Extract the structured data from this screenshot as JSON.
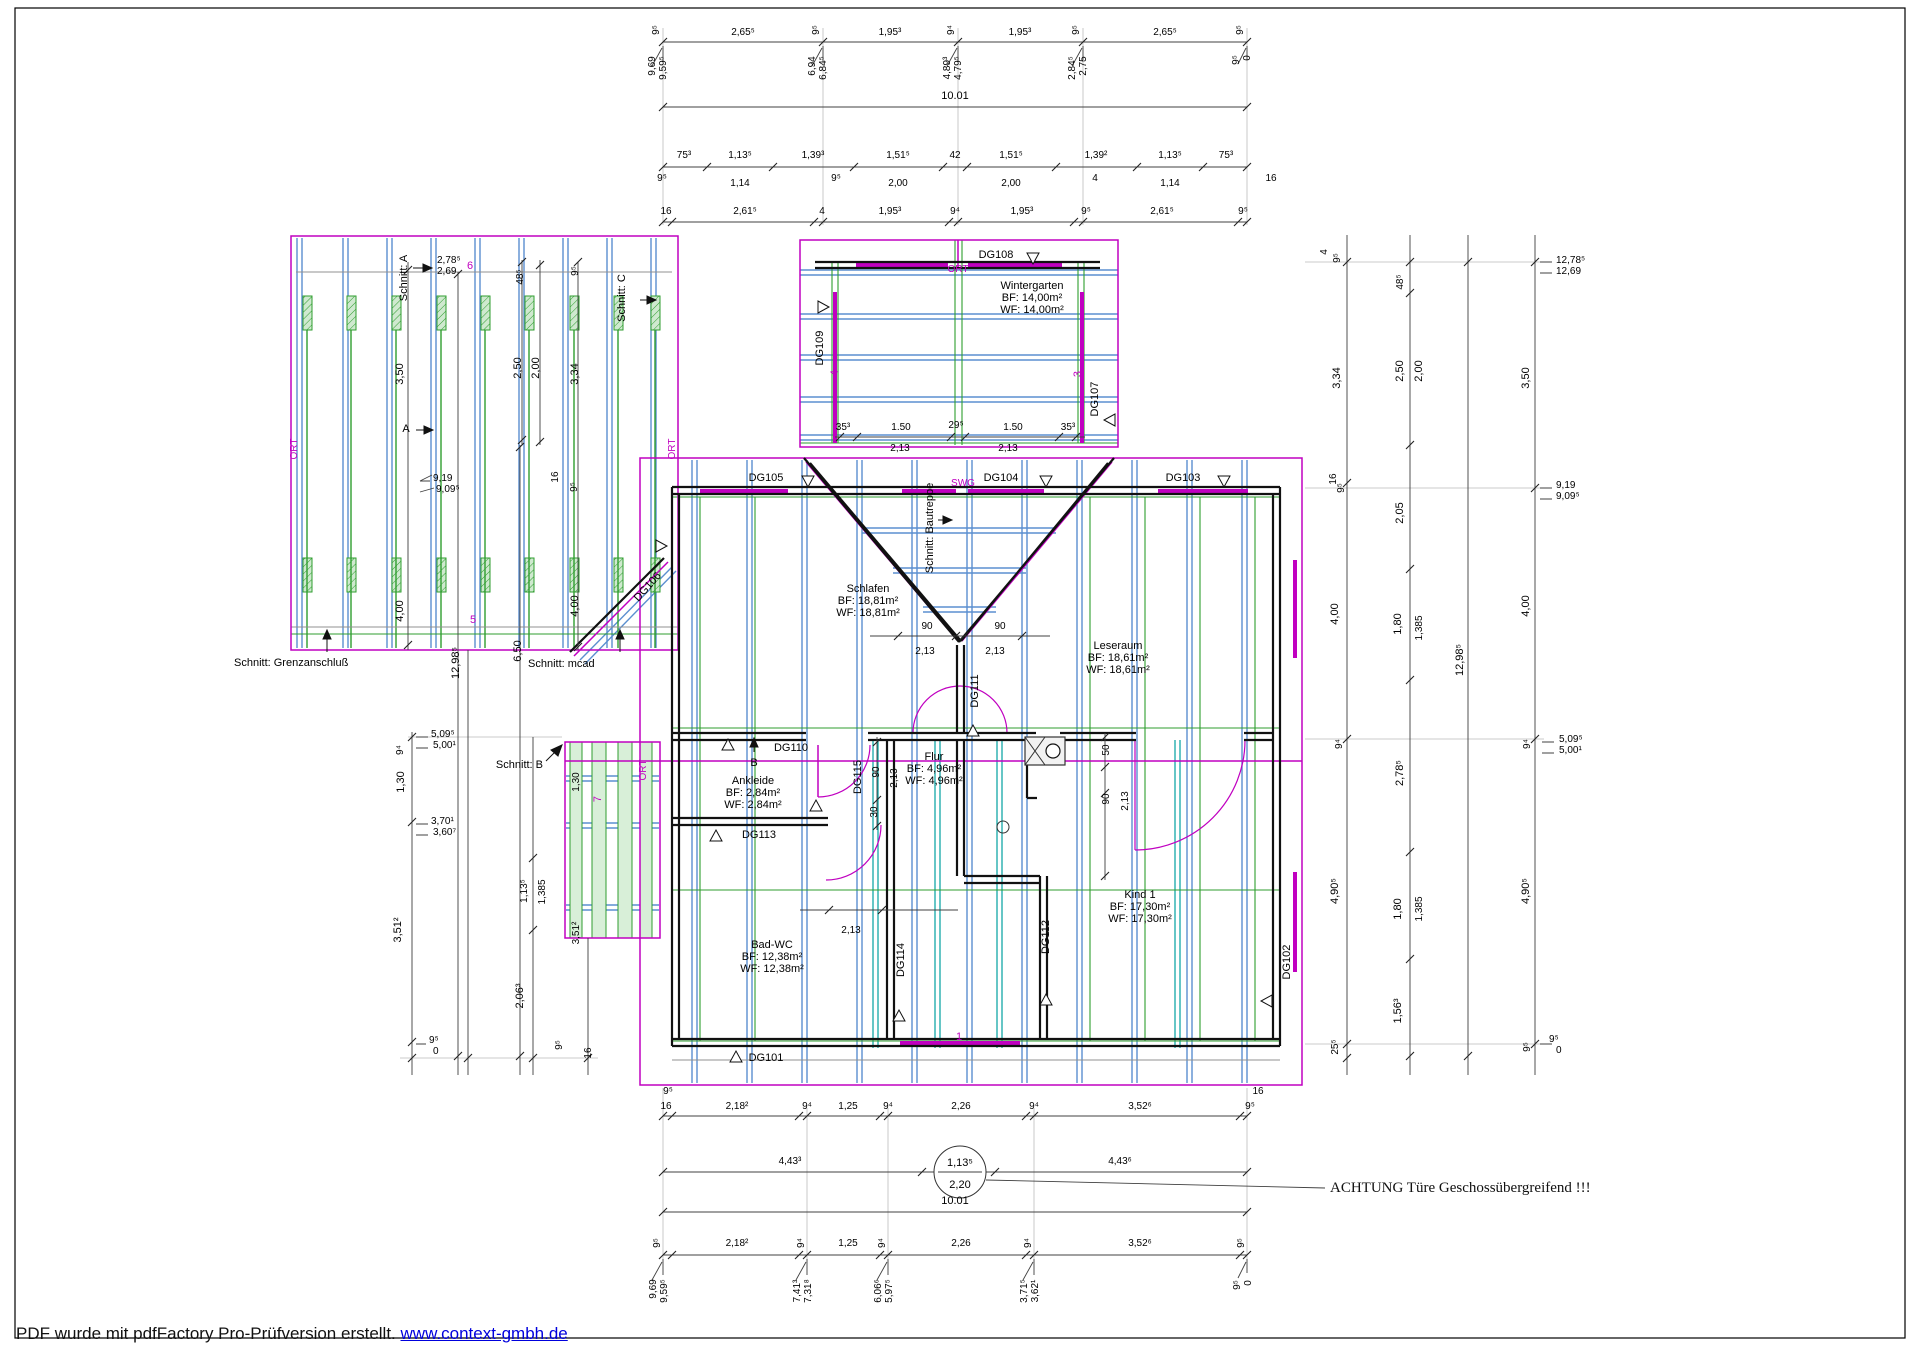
{
  "watermark": {
    "text": "PDF wurde mit pdfFactory Pro-Prüfversion erstellt. ",
    "link": "www.context-gmbh.de"
  },
  "notes": {
    "achtung": "ACHTUNG Türe Geschossübergreifend !!!"
  },
  "colors": {
    "magenta": "#c000c0",
    "blue": "#5b8fd0",
    "teal": "#00a0a0",
    "green": "#2f9e2f",
    "green_fill": "#cfe9cf",
    "wall": "#111111",
    "dim": "#404040"
  },
  "rooms": [
    {
      "name": "Wintergarten",
      "bf": "14,00m²",
      "wf": "14,00m²",
      "x": 1032,
      "y": 289
    },
    {
      "name": "Schlafen",
      "bf": "18,81m²",
      "wf": "18,81m²",
      "x": 868,
      "y": 592
    },
    {
      "name": "Leseraum",
      "bf": "18,61m²",
      "wf": "18,61m²",
      "x": 1118,
      "y": 649
    },
    {
      "name": "Ankleide",
      "bf": "2,84m²",
      "wf": "2,84m²",
      "x": 753,
      "y": 784
    },
    {
      "name": "Flur",
      "bf": "4,96m²",
      "wf": "4,96m²",
      "x": 934,
      "y": 760
    },
    {
      "name": "Bad-WC",
      "bf": "12,38m²",
      "wf": "12,38m²",
      "x": 772,
      "y": 948
    },
    {
      "name": "Kind 1",
      "bf": "17,30m²",
      "wf": "17,30m²",
      "x": 1140,
      "y": 898
    }
  ],
  "door_tags": [
    {
      "id": "DG101",
      "x": 766,
      "y": 1061
    },
    {
      "id": "DG102",
      "x": 1290,
      "y": 962,
      "r": -90
    },
    {
      "id": "DG103",
      "x": 1183,
      "y": 481
    },
    {
      "id": "DG104",
      "x": 1001,
      "y": 481
    },
    {
      "id": "DG105",
      "x": 766,
      "y": 481
    },
    {
      "id": "DG106",
      "x": 650,
      "y": 589,
      "r": -48
    },
    {
      "id": "DG107",
      "x": 1098,
      "y": 399,
      "r": -90
    },
    {
      "id": "DG108",
      "x": 996,
      "y": 258
    },
    {
      "id": "DG109",
      "x": 823,
      "y": 348,
      "r": -90
    },
    {
      "id": "DG110",
      "x": 791,
      "y": 751
    },
    {
      "id": "DG111",
      "x": 978,
      "y": 691,
      "r": -90
    },
    {
      "id": "DG112",
      "x": 1049,
      "y": 937,
      "r": -90
    },
    {
      "id": "DG113",
      "x": 759,
      "y": 838
    },
    {
      "id": "DG114",
      "x": 904,
      "y": 960,
      "r": -90
    },
    {
      "id": "DG115",
      "x": 861,
      "y": 777,
      "r": -90
    }
  ],
  "markers": [
    {
      "t": "6",
      "x": 470,
      "y": 269
    },
    {
      "t": "5",
      "x": 473,
      "y": 623
    },
    {
      "t": "7",
      "x": 601,
      "y": 799,
      "r": -90
    },
    {
      "t": "4",
      "x": 838,
      "y": 373,
      "r": -90
    },
    {
      "t": "3",
      "x": 1081,
      "y": 374,
      "r": -90
    },
    {
      "t": "1",
      "x": 959,
      "y": 1040
    },
    {
      "t": "SWG",
      "x": 963,
      "y": 486
    },
    {
      "t": "ORT",
      "x": 297,
      "y": 449,
      "r": -90
    },
    {
      "t": "ORT",
      "x": 675,
      "y": 449,
      "r": -90
    },
    {
      "t": "ORT",
      "x": 958,
      "y": 272
    },
    {
      "t": "ORT",
      "x": 646,
      "y": 770,
      "r": -90
    }
  ],
  "section_labels": [
    {
      "t": "Schnitt: A",
      "x": 407,
      "y": 278,
      "r": -90
    },
    {
      "t": "Schnitt: C",
      "x": 625,
      "y": 298,
      "r": -90
    },
    {
      "t": "Schnitt: Grenzanschluß",
      "x": 234,
      "y": 666,
      "a": "s"
    },
    {
      "t": "Schnitt:  mcad",
      "x": 528,
      "y": 667,
      "a": "s"
    },
    {
      "t": "Schnitt:  B",
      "x": 543,
      "y": 768,
      "a": "e"
    },
    {
      "t": "Schnitt: Bautreppe",
      "x": 933,
      "y": 528,
      "r": -90
    },
    {
      "t": "A",
      "x": 406,
      "y": 432
    },
    {
      "t": "B",
      "x": 754,
      "y": 766
    }
  ],
  "dim_labels": [
    {
      "t": "2,65⁵",
      "x": 743,
      "y": 35
    },
    {
      "t": "1,95³",
      "x": 890,
      "y": 35
    },
    {
      "t": "1,95³",
      "x": 1020,
      "y": 35
    },
    {
      "t": "2,65⁵",
      "x": 1165,
      "y": 35
    },
    {
      "t": "9⁵",
      "x": 659,
      "y": 30,
      "r": -90
    },
    {
      "t": "9⁵",
      "x": 819,
      "y": 30,
      "r": -90
    },
    {
      "t": "9⁴",
      "x": 954,
      "y": 30,
      "r": -90
    },
    {
      "t": "9⁵",
      "x": 1079,
      "y": 30,
      "r": -90
    },
    {
      "t": "9⁵",
      "x": 1243,
      "y": 30,
      "r": -90
    },
    {
      "t": "9,69",
      "x": 655,
      "y": 66,
      "r": -90
    },
    {
      "t": "9,59⁵",
      "x": 666,
      "y": 68,
      "r": -90
    },
    {
      "t": "6,94",
      "x": 815,
      "y": 66,
      "r": -90
    },
    {
      "t": "6,84⁵",
      "x": 826,
      "y": 68,
      "r": -90
    },
    {
      "t": "4,89³",
      "x": 950,
      "y": 68,
      "r": -90
    },
    {
      "t": "4,79⁵",
      "x": 961,
      "y": 68,
      "r": -90
    },
    {
      "t": "2,84⁵",
      "x": 1075,
      "y": 68,
      "r": -90
    },
    {
      "t": "2,75",
      "x": 1086,
      "y": 66,
      "r": -90
    },
    {
      "t": "9⁵",
      "x": 1239,
      "y": 60,
      "r": -90
    },
    {
      "t": "0",
      "x": 1250,
      "y": 58,
      "r": -90
    },
    {
      "t": "10.01",
      "x": 955,
      "y": 99,
      "s": 11
    },
    {
      "t": "75³",
      "x": 684,
      "y": 158
    },
    {
      "t": "1,13⁵",
      "x": 740,
      "y": 158
    },
    {
      "t": "1,39³",
      "x": 813,
      "y": 158
    },
    {
      "t": "1,51⁵",
      "x": 898,
      "y": 158
    },
    {
      "t": "42",
      "x": 955,
      "y": 158
    },
    {
      "t": "1,51⁵",
      "x": 1011,
      "y": 158
    },
    {
      "t": "1,39²",
      "x": 1096,
      "y": 158
    },
    {
      "t": "1,13⁵",
      "x": 1170,
      "y": 158
    },
    {
      "t": "75³",
      "x": 1226,
      "y": 158
    },
    {
      "t": "1,14",
      "x": 740,
      "y": 186
    },
    {
      "t": "2,00",
      "x": 898,
      "y": 186
    },
    {
      "t": "2,00",
      "x": 1011,
      "y": 186
    },
    {
      "t": "1,14",
      "x": 1170,
      "y": 186
    },
    {
      "t": "9⁵",
      "x": 662,
      "y": 181
    },
    {
      "t": "9⁵",
      "x": 836,
      "y": 181
    },
    {
      "t": "4",
      "x": 1095,
      "y": 181
    },
    {
      "t": "16",
      "x": 1271,
      "y": 181
    },
    {
      "t": "16",
      "x": 666,
      "y": 214
    },
    {
      "t": "2,61⁵",
      "x": 745,
      "y": 214
    },
    {
      "t": "4",
      "x": 822,
      "y": 214
    },
    {
      "t": "1,95³",
      "x": 890,
      "y": 214
    },
    {
      "t": "9⁴",
      "x": 955,
      "y": 214
    },
    {
      "t": "1,95³",
      "x": 1022,
      "y": 214
    },
    {
      "t": "9⁵",
      "x": 1086,
      "y": 214
    },
    {
      "t": "2,61⁵",
      "x": 1162,
      "y": 214
    },
    {
      "t": "9⁵",
      "x": 1243,
      "y": 214
    },
    {
      "t": "2,78⁵",
      "x": 437,
      "y": 263,
      "a": "s"
    },
    {
      "t": "2,69",
      "x": 437,
      "y": 274,
      "a": "s"
    },
    {
      "t": "48⁵",
      "x": 523,
      "y": 277,
      "r": -90
    },
    {
      "t": "9⁵",
      "x": 578,
      "y": 271,
      "r": -90
    },
    {
      "t": "3,50",
      "x": 403,
      "y": 374,
      "r": -90,
      "s": 11
    },
    {
      "t": "2,50",
      "x": 521,
      "y": 368,
      "r": -90,
      "s": 11
    },
    {
      "t": "2,00",
      "x": 539,
      "y": 368,
      "r": -90,
      "s": 11
    },
    {
      "t": "3,34",
      "x": 578,
      "y": 374,
      "r": -90,
      "s": 11
    },
    {
      "t": "9,19",
      "x": 433,
      "y": 481,
      "a": "s"
    },
    {
      "t": "9,09⁵",
      "x": 436,
      "y": 492,
      "a": "s"
    },
    {
      "t": "16",
      "x": 558,
      "y": 477,
      "r": -90
    },
    {
      "t": "9⁵",
      "x": 577,
      "y": 487,
      "r": -90
    },
    {
      "t": "4,00",
      "x": 403,
      "y": 611,
      "r": -90,
      "s": 11
    },
    {
      "t": "4,00",
      "x": 578,
      "y": 606,
      "r": -90,
      "s": 11
    },
    {
      "t": "12,98⁵",
      "x": 459,
      "y": 663,
      "r": -90,
      "s": 11
    },
    {
      "t": "6,50",
      "x": 521,
      "y": 651,
      "r": -90,
      "s": 11
    },
    {
      "t": "5,09⁵",
      "x": 431,
      "y": 737,
      "a": "s"
    },
    {
      "t": "5,00¹",
      "x": 433,
      "y": 748,
      "a": "s"
    },
    {
      "t": "9⁴",
      "x": 403,
      "y": 750,
      "r": -90
    },
    {
      "t": "1,30",
      "x": 404,
      "y": 782,
      "r": -90,
      "s": 11
    },
    {
      "t": "3,70¹",
      "x": 431,
      "y": 824,
      "a": "s"
    },
    {
      "t": "3,60⁷",
      "x": 433,
      "y": 835,
      "a": "s"
    },
    {
      "t": "3,51²",
      "x": 401,
      "y": 930,
      "r": -90,
      "s": 11
    },
    {
      "t": "9⁵",
      "x": 429,
      "y": 1043,
      "a": "s"
    },
    {
      "t": "0",
      "x": 433,
      "y": 1054,
      "a": "s"
    },
    {
      "t": "1,13⁵",
      "x": 527,
      "y": 891,
      "r": -90
    },
    {
      "t": "1,385",
      "x": 545,
      "y": 892,
      "r": -90
    },
    {
      "t": "2,06³",
      "x": 523,
      "y": 996,
      "r": -90,
      "s": 11
    },
    {
      "t": "9⁵",
      "x": 562,
      "y": 1045,
      "r": -90
    },
    {
      "t": "16",
      "x": 591,
      "y": 1053,
      "r": -90
    },
    {
      "t": "1,30",
      "x": 579,
      "y": 782,
      "r": -90
    },
    {
      "t": "3,51²",
      "x": 579,
      "y": 933,
      "r": -90
    },
    {
      "t": "35³",
      "x": 843,
      "y": 430
    },
    {
      "t": "1.50",
      "x": 901,
      "y": 430
    },
    {
      "t": "29⁵",
      "x": 956,
      "y": 428
    },
    {
      "t": "1.50",
      "x": 1013,
      "y": 430
    },
    {
      "t": "35³",
      "x": 1068,
      "y": 430
    },
    {
      "t": "2,13",
      "x": 900,
      "y": 451
    },
    {
      "t": "2,13",
      "x": 1008,
      "y": 451
    },
    {
      "t": "90",
      "x": 927,
      "y": 629
    },
    {
      "t": "90",
      "x": 1000,
      "y": 629
    },
    {
      "t": "2,13",
      "x": 925,
      "y": 654
    },
    {
      "t": "2,13",
      "x": 995,
      "y": 654
    },
    {
      "t": "90",
      "x": 879,
      "y": 772,
      "r": -90
    },
    {
      "t": "2,13",
      "x": 897,
      "y": 778,
      "r": -90
    },
    {
      "t": "30",
      "x": 877,
      "y": 812,
      "r": -90
    },
    {
      "t": "50",
      "x": 1109,
      "y": 750,
      "r": -90
    },
    {
      "t": "90",
      "x": 1109,
      "y": 799,
      "r": -90
    },
    {
      "t": "2,13",
      "x": 1128,
      "y": 801,
      "r": -90
    },
    {
      "t": "2,13",
      "x": 851,
      "y": 933
    },
    {
      "t": "9⁵",
      "x": 668,
      "y": 1094
    },
    {
      "t": "16",
      "x": 1258,
      "y": 1094
    },
    {
      "t": "16",
      "x": 666,
      "y": 1109
    },
    {
      "t": "2,18²",
      "x": 737,
      "y": 1109
    },
    {
      "t": "9⁴",
      "x": 807,
      "y": 1109
    },
    {
      "t": "1,25",
      "x": 848,
      "y": 1109
    },
    {
      "t": "9⁴",
      "x": 888,
      "y": 1109
    },
    {
      "t": "2,26",
      "x": 961,
      "y": 1109
    },
    {
      "t": "9⁴",
      "x": 1034,
      "y": 1109
    },
    {
      "t": "3,52⁶",
      "x": 1140,
      "y": 1109
    },
    {
      "t": "9⁵",
      "x": 1250,
      "y": 1109
    },
    {
      "t": "4,43³",
      "x": 790,
      "y": 1164
    },
    {
      "t": "4,43⁶",
      "x": 1120,
      "y": 1164
    },
    {
      "t": "1,13⁵",
      "x": 960,
      "y": 1166,
      "s": 11
    },
    {
      "t": "2,20",
      "x": 960,
      "y": 1188,
      "s": 11
    },
    {
      "t": "10.01",
      "x": 955,
      "y": 1204,
      "s": 11
    },
    {
      "t": "2,18²",
      "x": 737,
      "y": 1246
    },
    {
      "t": "1,25",
      "x": 848,
      "y": 1246
    },
    {
      "t": "2,26",
      "x": 961,
      "y": 1246
    },
    {
      "t": "3,52⁶",
      "x": 1140,
      "y": 1246
    },
    {
      "t": "9⁵",
      "x": 660,
      "y": 1243,
      "r": -90
    },
    {
      "t": "9⁴",
      "x": 804,
      "y": 1243,
      "r": -90
    },
    {
      "t": "9⁴",
      "x": 885,
      "y": 1243,
      "r": -90
    },
    {
      "t": "9⁴",
      "x": 1031,
      "y": 1243,
      "r": -90
    },
    {
      "t": "9⁵",
      "x": 1244,
      "y": 1243,
      "r": -90
    },
    {
      "t": "9,69",
      "x": 656,
      "y": 1289,
      "r": -90
    },
    {
      "t": "9,59⁵",
      "x": 667,
      "y": 1291,
      "r": -90
    },
    {
      "t": "7,41³",
      "x": 800,
      "y": 1291,
      "r": -90
    },
    {
      "t": "7,31⁸",
      "x": 811,
      "y": 1291,
      "r": -90
    },
    {
      "t": "6,06⁶",
      "x": 881,
      "y": 1291,
      "r": -90
    },
    {
      "t": "5,97⁵",
      "x": 892,
      "y": 1291,
      "r": -90
    },
    {
      "t": "3,71⁵",
      "x": 1027,
      "y": 1291,
      "r": -90
    },
    {
      "t": "3,62¹",
      "x": 1038,
      "y": 1291,
      "r": -90
    },
    {
      "t": "9⁵",
      "x": 1240,
      "y": 1285,
      "r": -90
    },
    {
      "t": "0",
      "x": 1251,
      "y": 1283,
      "r": -90
    },
    {
      "t": "4",
      "x": 1327,
      "y": 252,
      "r": -90
    },
    {
      "t": "9⁵",
      "x": 1340,
      "y": 258,
      "r": -90
    },
    {
      "t": "48⁵",
      "x": 1403,
      "y": 282,
      "r": -90
    },
    {
      "t": "12,78⁵",
      "x": 1556,
      "y": 263,
      "a": "s"
    },
    {
      "t": "12,69",
      "x": 1556,
      "y": 274,
      "a": "s"
    },
    {
      "t": "3,34",
      "x": 1340,
      "y": 378,
      "r": -90,
      "s": 11
    },
    {
      "t": "2,50",
      "x": 1403,
      "y": 371,
      "r": -90,
      "s": 11
    },
    {
      "t": "2,00",
      "x": 1422,
      "y": 371,
      "r": -90,
      "s": 11
    },
    {
      "t": "3,50",
      "x": 1529,
      "y": 378,
      "r": -90,
      "s": 11
    },
    {
      "t": "16",
      "x": 1336,
      "y": 479,
      "r": -90
    },
    {
      "t": "9⁵",
      "x": 1344,
      "y": 488,
      "r": -90
    },
    {
      "t": "9,19",
      "x": 1556,
      "y": 488,
      "a": "s"
    },
    {
      "t": "9,09⁵",
      "x": 1556,
      "y": 499,
      "a": "s"
    },
    {
      "t": "2,05",
      "x": 1403,
      "y": 513,
      "r": -90,
      "s": 11
    },
    {
      "t": "4,00",
      "x": 1338,
      "y": 614,
      "r": -90,
      "s": 11
    },
    {
      "t": "1,80",
      "x": 1401,
      "y": 624,
      "r": -90,
      "s": 11
    },
    {
      "t": "1,385",
      "x": 1422,
      "y": 628,
      "r": -90
    },
    {
      "t": "12,98⁵",
      "x": 1463,
      "y": 660,
      "r": -90,
      "s": 11
    },
    {
      "t": "4,00",
      "x": 1529,
      "y": 606,
      "r": -90,
      "s": 11
    },
    {
      "t": "9⁴",
      "x": 1342,
      "y": 744,
      "r": -90
    },
    {
      "t": "9⁴",
      "x": 1530,
      "y": 744,
      "r": -90
    },
    {
      "t": "5,09⁵",
      "x": 1559,
      "y": 742,
      "a": "s"
    },
    {
      "t": "5,00¹",
      "x": 1559,
      "y": 753,
      "a": "s"
    },
    {
      "t": "2,78⁵",
      "x": 1403,
      "y": 773,
      "r": -90,
      "s": 11
    },
    {
      "t": "4,90⁵",
      "x": 1338,
      "y": 891,
      "r": -90,
      "s": 11
    },
    {
      "t": "1,80",
      "x": 1401,
      "y": 909,
      "r": -90,
      "s": 11
    },
    {
      "t": "1,385",
      "x": 1422,
      "y": 909,
      "r": -90
    },
    {
      "t": "1,56³",
      "x": 1401,
      "y": 1011,
      "r": -90,
      "s": 11
    },
    {
      "t": "4,90⁵",
      "x": 1529,
      "y": 891,
      "r": -90,
      "s": 11
    },
    {
      "t": "25⁵",
      "x": 1338,
      "y": 1047,
      "r": -90
    },
    {
      "t": "9⁵",
      "x": 1530,
      "y": 1047,
      "r": -90
    },
    {
      "t": "9⁵",
      "x": 1549,
      "y": 1042,
      "a": "s"
    },
    {
      "t": "0",
      "x": 1556,
      "y": 1053,
      "a": "s"
    }
  ]
}
